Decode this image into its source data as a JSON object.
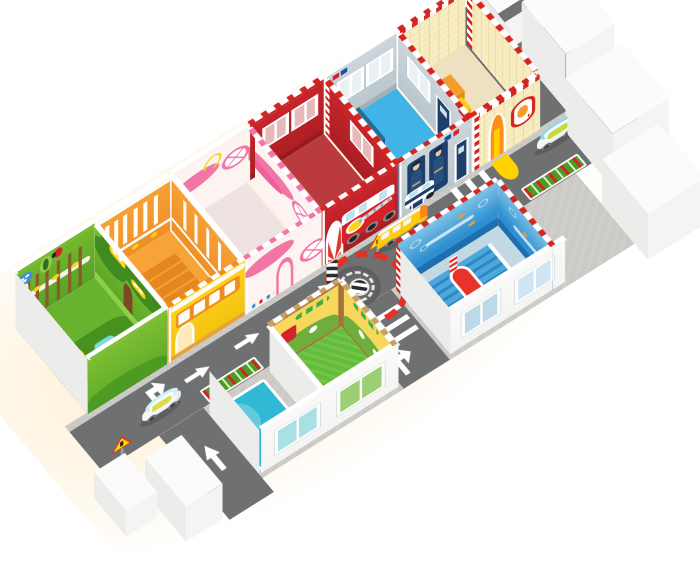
{
  "scene": {
    "description": "isometric 3d cutaway rendering of a children's indoor playground: six themed rooms along an indoor traffic road with toy cars, road markings, a roundabout, farm yard with a cow, ocean stair room and splash pool",
    "background": "#ffffff"
  },
  "rooms": {
    "forest": {
      "label": "forest play room",
      "wall": "#74b92e",
      "floor": "#67b22e",
      "floor_band": "#47921f",
      "canopy": "#3f8b1f",
      "trunk": "#7a4a22",
      "mushroom_cap": "#3f8fd8",
      "ladybug": "#d6212a",
      "ball": "#ffd21c",
      "barrel": "#3e7a66"
    },
    "school_bus": {
      "label": "school bus room",
      "wall": "#f6a238",
      "floor": "#f6a338",
      "bus_body": "#ffd21c",
      "bus_window_band": "#f08c1e",
      "seat": "#e4871f",
      "dash": "#f08c1e"
    },
    "airplane": {
      "label": "airplane room",
      "wall": "#fdf4f2",
      "floor": "#eee3e0",
      "pink": "#f176a6",
      "pink_deep": "#ee5f9b",
      "squiggle": "#ffd21c",
      "dash": "#f176a6"
    },
    "fire_station": {
      "label": "fire station room",
      "wall": "#c9252b",
      "floor": "#bb3a3d",
      "truck": "#d6212a",
      "emblem": "#ffd21c",
      "ladder": "#d9dadc",
      "dash": "#d5251f"
    },
    "police_station": {
      "label": "police station room",
      "wall": "#ccd6dc",
      "floor": "#41b3e6",
      "platform": "#1e6f9c",
      "panel": "#1d3f6b",
      "accent_red": "#d6212a",
      "accent_blue": "#1f4fa0",
      "dash": "#d5251f"
    },
    "kitchen": {
      "label": "kitchen play house",
      "wall": "#f7ecc2",
      "tile_line": "#e7d49a",
      "floor": "#efe0c2",
      "slide": "#ffd200",
      "slide_frame": "#ff8d1e",
      "box_orange": "#f59d2b",
      "box_yellow": "#ffca10",
      "dash": "#d5251f"
    },
    "farm": {
      "label": "farm yard with cow",
      "grass": "#64bd3a",
      "mural": "#f7d75c",
      "frame": "#a4713a",
      "barn": "#d6212a",
      "hill": "#6fae3c",
      "dash": "#c9a063"
    },
    "ocean": {
      "label": "ocean stair room",
      "deck": "#c2d9e4",
      "mural_top": "#7fc3e8",
      "mural": "#2f8fd0",
      "footer": "#1f6fae",
      "stair": "#4aa8de",
      "stair_dark": "#2f86c0",
      "slide": "#e8332a",
      "dash": "#d5251f"
    },
    "pool": {
      "label": "splash pool",
      "water": "#2fb9d4",
      "water_light": "#7fdbe8",
      "frame": "#ffffff"
    }
  },
  "street": {
    "road": "#6f7072",
    "concrete": "#c9c8c4",
    "apron": "#cbcac6",
    "marking": "#ffffff",
    "roundabout": "#5c5d5f",
    "hub": "#2b2b2b",
    "barrier": "#e23227",
    "flower_green": "#4e9b23",
    "flower_red": "#d6212a",
    "sign_red": "#e23227",
    "sign_yellow": "#ffd900",
    "glow": "#ffd78c"
  },
  "exterior": {
    "wall_south": "#f4f4f2",
    "wall_west": "#ececea",
    "wall_top": "#fbfbfa",
    "window_pane_pool": "#a8e0e6",
    "window_pane_grass": "#9ccf74",
    "window_pane_sky": "#cfe6f2",
    "window_pane_ocean": "#bcd9ea"
  },
  "vehicles": {
    "school_bus": {
      "label": "toy school bus",
      "body": "#ffca10",
      "stripe": "#f6871f",
      "window": "#eef6f8",
      "wheel": "#2e2e2e"
    },
    "car_east": {
      "label": "toy car near kitchen corner",
      "body": "#f4f6f6",
      "roof": "#8fd8df",
      "seat": "#c7da3d",
      "wheel": "#3a3a3a"
    },
    "car_entrance": {
      "label": "toy car at south entrance",
      "body": "#f4f6f6",
      "roof": "#cdeff3",
      "seat": "#e0d94e",
      "wheel": "#3a3a3a"
    }
  },
  "animals": {
    "cow": {
      "label": "cow",
      "body": "#f2efe6",
      "spots": "#33302c"
    }
  }
}
